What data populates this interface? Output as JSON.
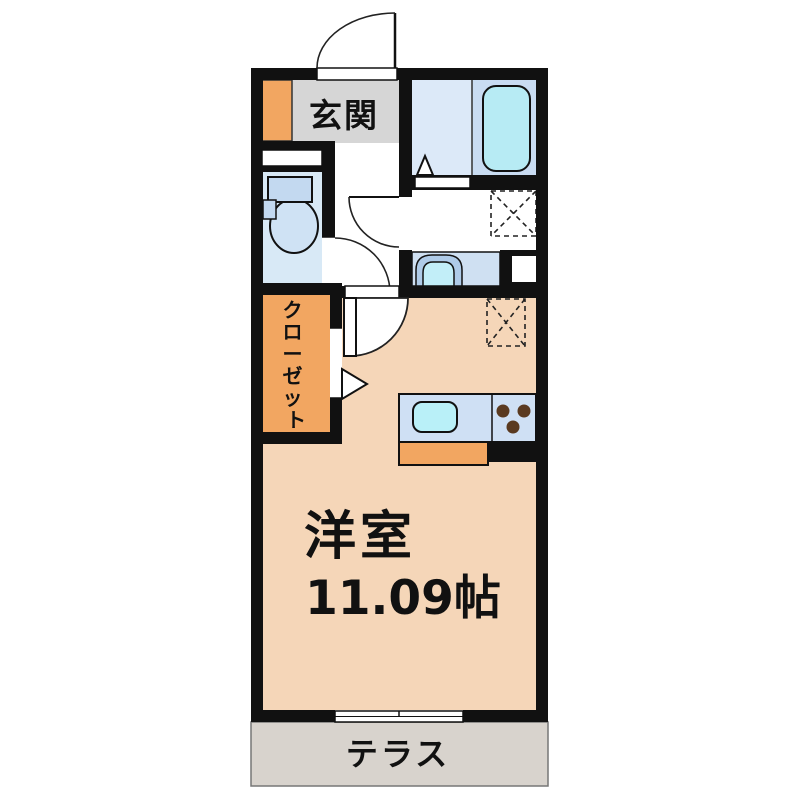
{
  "page": {
    "background": "#ffffff",
    "kind": "apartment floor plan"
  },
  "floorplan": {
    "entrance": {
      "label": "玄関"
    },
    "closet": {
      "label": "クローゼット",
      "chars": [
        "ク",
        "ロ",
        "ー",
        "ゼ",
        "ッ",
        "ト"
      ]
    },
    "main_room": {
      "label": "洋室",
      "size": "11.09帖"
    },
    "terrace": {
      "label": "テラス"
    },
    "colors": {
      "wall": "#111111",
      "room_floor": "#f5d6b8",
      "entrance_floor": "#d6d6d6",
      "terrace_floor": "#d8d3cd",
      "storage_orange": "#f2a661",
      "bath_floor_left": "#dce9f8",
      "bath_floor_right": "#c9dcf2",
      "bathtub": "#b7ebf4",
      "toilet_floor": "#d8e9f6",
      "fixture_blue": "#c3d9f0",
      "counter_blue": "#cfe0f2",
      "sink_cyan": "#b9f0f8",
      "burner_brown": "#5a3a20"
    },
    "fixtures": [
      "entrance-door",
      "shoe-cabinet",
      "toilet",
      "bathtub",
      "washbasin",
      "washing-machine-space",
      "refrigerator-space",
      "kitchen-sink",
      "stove-burners",
      "closet",
      "sliding-window",
      "terrace"
    ]
  }
}
